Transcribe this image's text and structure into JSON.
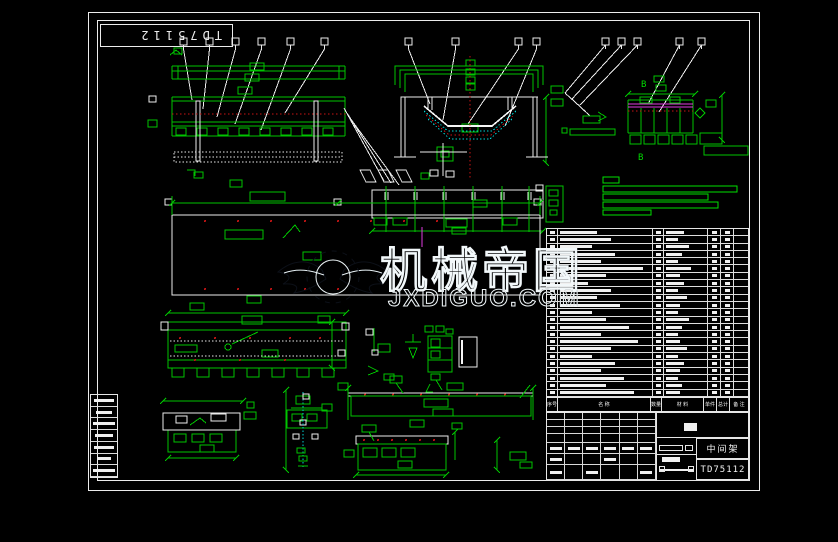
{
  "sheet": {
    "corner_stamp": "TD75112",
    "background": "#000000",
    "line_green": "#00c400",
    "line_white": "#ececec",
    "line_magenta": "#e03ce0",
    "line_red": "#c81414",
    "line_cyan": "#00d2d2"
  },
  "detail_b": {
    "label_top": "B",
    "label_bottom": "B"
  },
  "watermark": {
    "monogram": "JX",
    "title": "机械帝国",
    "domain": "JXDIGUO.COM",
    "fill": "#a9cdd9",
    "outline": "#f2f8fa",
    "shadow": "#0c1018",
    "wing_color": "#4e9ab8"
  },
  "bom": {
    "headers": [
      "序号",
      "名 称",
      "数量",
      "材 料",
      "单件",
      "总计",
      "备 注"
    ],
    "rows": [
      {
        "n": 40,
        "m": 45
      },
      {
        "n": 55,
        "m": 30
      },
      {
        "n": 35,
        "m": 55
      },
      {
        "n": 60,
        "m": 40
      },
      {
        "n": 45,
        "m": 30
      },
      {
        "n": 90,
        "m": 60
      },
      {
        "n": 50,
        "m": 35
      },
      {
        "n": 30,
        "m": 45
      },
      {
        "n": 55,
        "m": 30
      },
      {
        "n": 40,
        "m": 50
      },
      {
        "n": 65,
        "m": 35
      },
      {
        "n": 35,
        "m": 30
      },
      {
        "n": 50,
        "m": 55
      },
      {
        "n": 75,
        "m": 40
      },
      {
        "n": 45,
        "m": 30
      },
      {
        "n": 85,
        "m": 35
      },
      {
        "n": 55,
        "m": 50
      },
      {
        "n": 35,
        "m": 30
      },
      {
        "n": 60,
        "m": 45
      },
      {
        "n": 45,
        "m": 35
      },
      {
        "n": 70,
        "m": 30
      },
      {
        "n": 50,
        "m": 40
      },
      {
        "n": 80,
        "m": 35
      }
    ]
  },
  "title_block": {
    "part_name": "中间架",
    "drawing_no": "TD75112"
  },
  "left_strip": {
    "rows": [
      20,
      16,
      22,
      18,
      20,
      14,
      22
    ]
  }
}
